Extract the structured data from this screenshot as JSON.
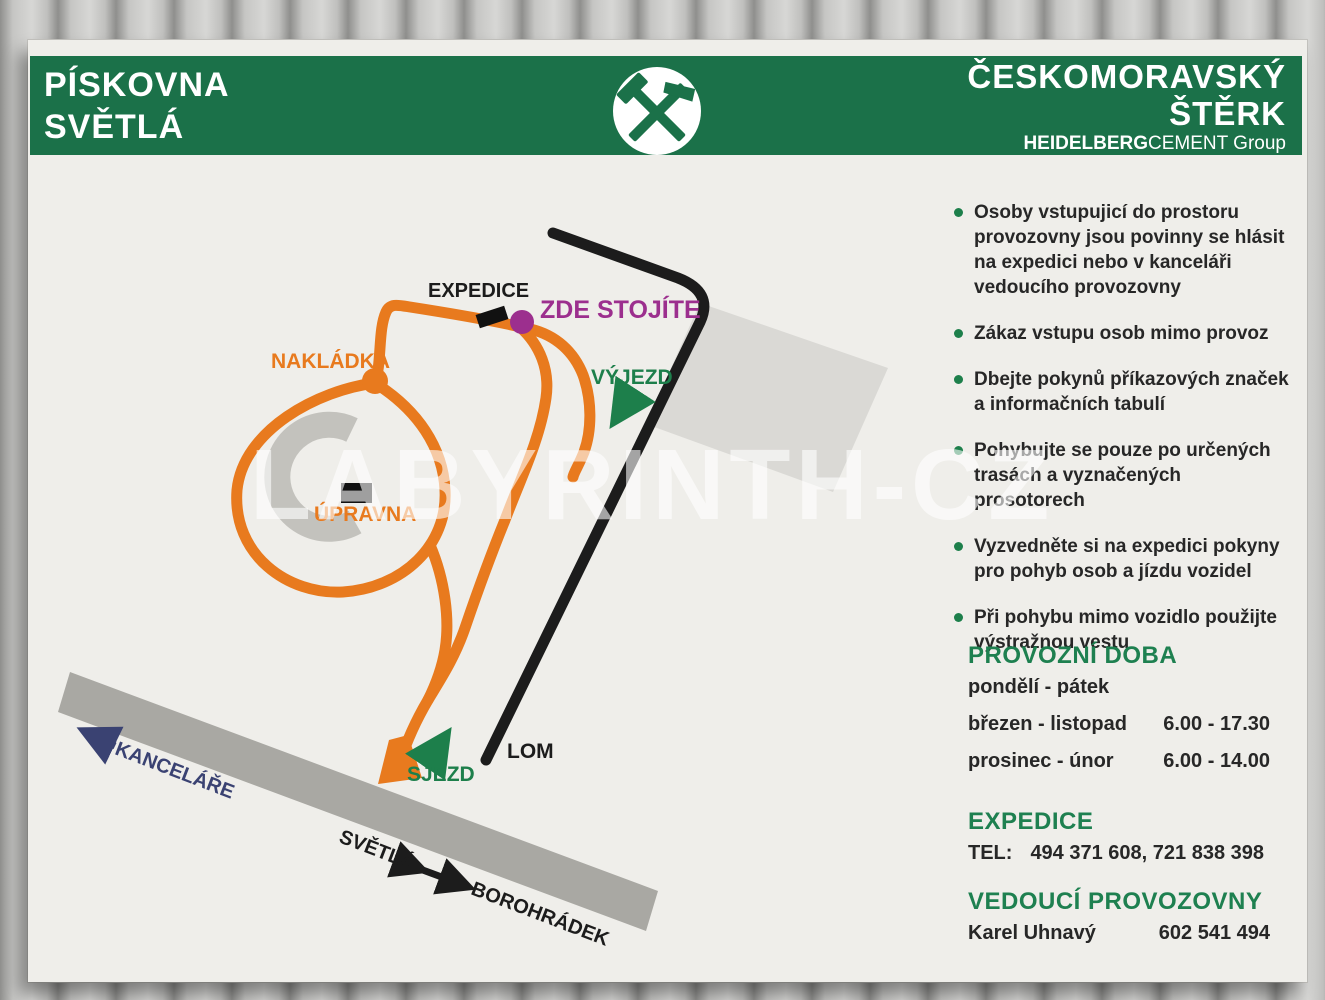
{
  "colors": {
    "header_green": "#1b7149",
    "panel": "#efeeea",
    "orange": "#e87a1e",
    "road_black": "#1c1c1c",
    "band_gray": "#a9a8a3",
    "crescent_gray": "#c3c2bd",
    "building_gray": "#dad9d5",
    "purple": "#9c2f8e",
    "map_green": "#1d7f4b",
    "navy": "#3a4272",
    "heading_green": "#1e8050",
    "text_dark": "#272727"
  },
  "header": {
    "site_title_line1": "PÍSKOVNA",
    "site_title_line2": "SVĚTLÁ",
    "company_line1": "ČESKOMORAVSKÝ",
    "company_line2": "ŠTĚRK",
    "brand_bold": "HEIDELBERG",
    "brand_regular": "CEMENT",
    "brand_suffix": " Group",
    "logo_icon": "hammer-and-pick-mining-icon"
  },
  "map": {
    "labels": {
      "expedice": "EXPEDICE",
      "zde_stojite": "ZDE STOJÍTE",
      "nakladka": "NAKLÁDKA",
      "vyjezd": "VÝJEZD",
      "upravna": "ÚPRAVNA",
      "lom": "LOM",
      "sjezd": "SJEZD",
      "kancelare": "KANCELÁŘE",
      "svetla": "SVĚTLÁ",
      "borohradek": "BOROHRÁDEK"
    }
  },
  "watermark": "LABYRINTH-CZ",
  "rules": [
    "Osoby vstupujicí do prostoru provozovny jsou povinny se hlásit na expedici nebo v kanceláři vedoucího provozovny",
    "Zákaz vstupu osob mimo provoz",
    "Dbejte pokynů příkazových značek a informačních tabulí",
    "Pohybujte se pouze po určených trasách a vyznačených prosotorech",
    "Vyzvedněte si na expedici pokyny pro pohyb osob a jízdu vozidel",
    "Při pohybu mimo vozidlo použijte výstražnou vestu"
  ],
  "hours": {
    "title": "PROVOZNÍ DOBA",
    "days": "pondělí - pátek",
    "rows": [
      {
        "period": "březen - listopad",
        "time": "6.00 - 17.30"
      },
      {
        "period": "prosinec - únor",
        "time": "6.00 - 14.00"
      }
    ]
  },
  "expedice": {
    "title": "EXPEDICE",
    "tel_label": "TEL:",
    "tel_numbers": "494 371 608, 721 838 398"
  },
  "manager": {
    "title": "VEDOUCÍ PROVOZOVNY",
    "name": "Karel Uhnavý",
    "phone": "602 541 494"
  }
}
